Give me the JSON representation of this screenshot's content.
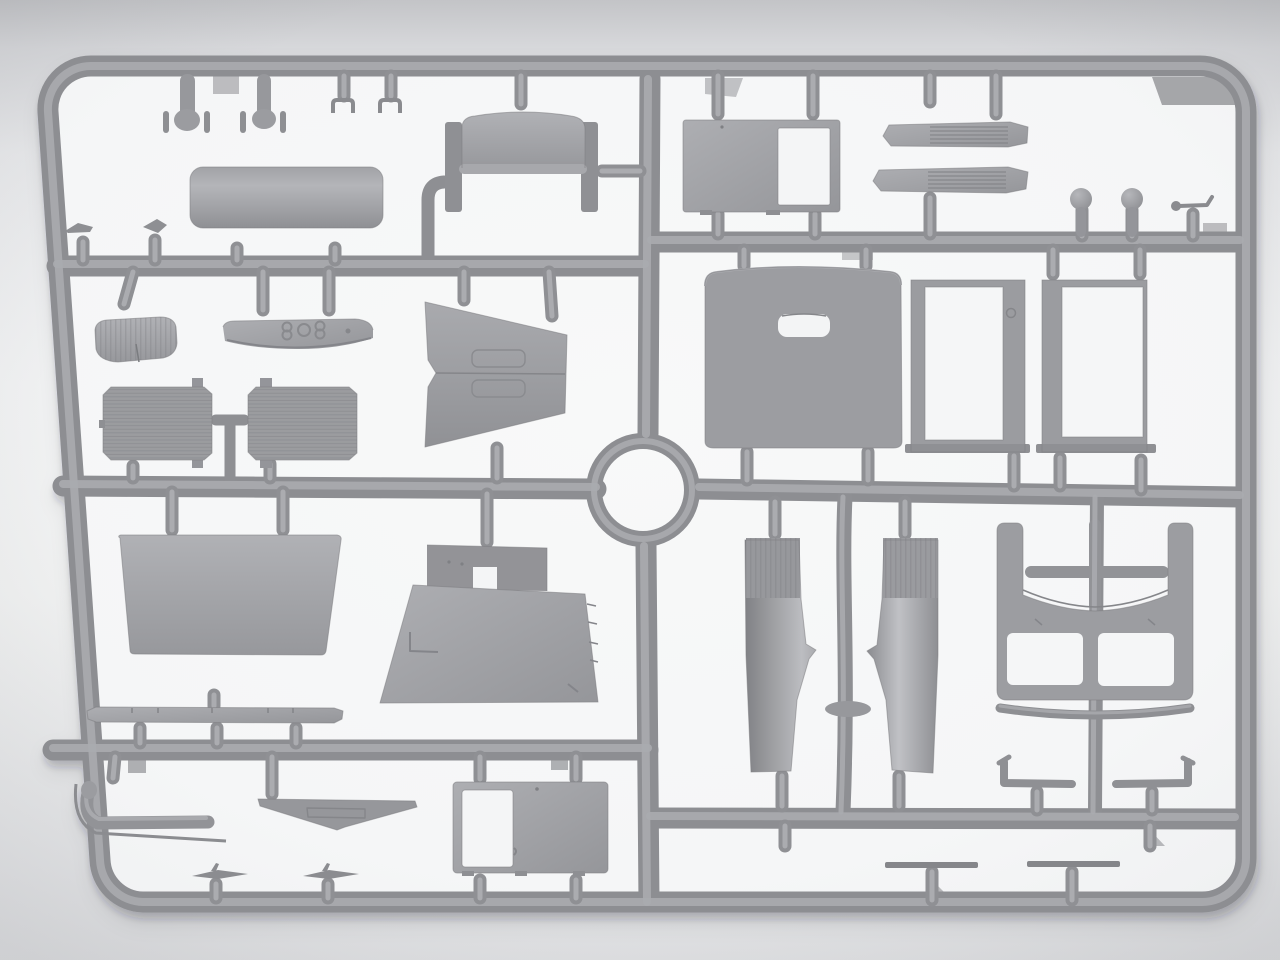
{
  "scene": {
    "subject": "unpainted gray plastic model-kit sprue (injection-molded runner frame with vehicle parts)",
    "backdrop": "neutral light-gray studio background, brighter inside the frame",
    "text_visible": false
  },
  "colors": {
    "plastic_mid": "#9b9ca0",
    "plastic_highlight": "#abacb0",
    "plastic_shadow": "#7e7f83",
    "thin_part": "#85868a",
    "backdrop_top": "#c3c4c7",
    "backdrop_mid": "#eff0f1",
    "backdrop_bottom": "#e3e4e6",
    "interior_white": "#f6f7f8",
    "part_shadow": "rgba(40,42,48,0.22)"
  },
  "sprue": {
    "frame_shape": "rounded rectangle with slight perspective lean",
    "junction_ring": "open circular runner ring left of center",
    "rows_left": 4,
    "rows_right": 4,
    "parts": [
      {
        "id": "t-pin-a",
        "name": "T-pin with side flanges"
      },
      {
        "id": "t-pin-b",
        "name": "T-pin with side flanges"
      },
      {
        "id": "clip-a",
        "name": "small U-clip"
      },
      {
        "id": "clip-b",
        "name": "small U-clip"
      },
      {
        "id": "fuel-tank-panel",
        "name": "rounded fuel tank panel"
      },
      {
        "id": "blade-wedge",
        "name": "tiny blade wedge"
      },
      {
        "id": "cone-plug",
        "name": "tiny cone plug"
      },
      {
        "id": "bench-seat",
        "name": "bench seat back with side panels"
      },
      {
        "id": "door-frame-panel",
        "name": "panel with window opening"
      },
      {
        "id": "louver-hood-a",
        "name": "louvered hood panel"
      },
      {
        "id": "louver-hood-b",
        "name": "louvered hood panel"
      },
      {
        "id": "ball-knob-a",
        "name": "ball knob"
      },
      {
        "id": "ball-knob-b",
        "name": "ball knob"
      },
      {
        "id": "hand-lever",
        "name": "hand lever"
      },
      {
        "id": "seat-cushion",
        "name": "ribbed seat cushion"
      },
      {
        "id": "dashboard-bow",
        "name": "curved bow piece with embossed 808 digits"
      },
      {
        "id": "radiator-core-a",
        "name": "finned radiator core"
      },
      {
        "id": "radiator-core-b",
        "name": "finned radiator core"
      },
      {
        "id": "hood-top-chevron",
        "name": "two-sided hood top panel"
      },
      {
        "id": "cab-rear-wall",
        "name": "cab rear wall with small window slot"
      },
      {
        "id": "window-frame-a",
        "name": "window frame"
      },
      {
        "id": "window-frame-b",
        "name": "window frame"
      },
      {
        "id": "windshield-panel",
        "name": "plain trapezoid windshield panel"
      },
      {
        "id": "cab-floor-panel",
        "name": "cab floor / firewall panel with cutout"
      },
      {
        "id": "bumper-bar",
        "name": "front bumper bar"
      },
      {
        "id": "front-fender-a",
        "name": "curved front fender with ribbed end"
      },
      {
        "id": "front-fender-b",
        "name": "curved front fender with ribbed end"
      },
      {
        "id": "roof-windshield-frame",
        "name": "cab roof and windshield frame"
      },
      {
        "id": "cowl-strip",
        "name": "curved cowl strip"
      },
      {
        "id": "boarding-step-a",
        "name": "boarding step bracket"
      },
      {
        "id": "boarding-step-b",
        "name": "boarding step bracket"
      },
      {
        "id": "exhaust-pipe",
        "name": "J-shaped exhaust pipe with flange"
      },
      {
        "id": "v-brace",
        "name": "V-shaped brace plate"
      },
      {
        "id": "cab-door",
        "name": "cab door with window opening"
      },
      {
        "id": "wiper-blade-a",
        "name": "small wiper blade"
      },
      {
        "id": "wiper-blade-b",
        "name": "small wiper blade"
      },
      {
        "id": "sill-strip-a",
        "name": "thin sill strip"
      },
      {
        "id": "sill-strip-b",
        "name": "thin sill strip"
      }
    ]
  }
}
